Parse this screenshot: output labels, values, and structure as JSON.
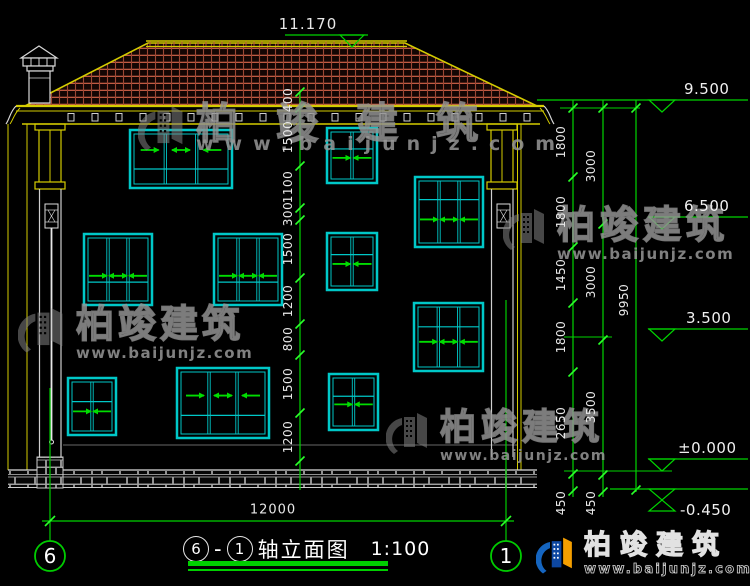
{
  "drawing": {
    "ridge_level": "11.170",
    "levels": [
      "9.500",
      "6.500",
      "3.500",
      "±0.000",
      "-0.450"
    ],
    "middle_chain": [
      "400",
      "1500",
      "1100",
      "300",
      "1500",
      "1200",
      "800",
      "1500",
      "1200"
    ],
    "right_chain_inner": [
      "1800",
      "1800",
      "1450",
      "1800",
      "2650",
      "450"
    ],
    "right_chain_outer": [
      "3000",
      "3000",
      "3500",
      "450"
    ],
    "total_height": "9950",
    "bottom_width": "12000",
    "axis_left": "6",
    "axis_right": "1",
    "title": {
      "axis_start": "6",
      "sep": "-",
      "axis_end": "1",
      "name": "轴立面图",
      "scale": "1:100"
    }
  },
  "watermark": {
    "brand": "柏竣建筑",
    "url": "www.baijunjz.com"
  },
  "logo": {
    "brand": "柏竣建筑",
    "url": "www.baijunjz.com"
  },
  "colors": {
    "dim_green": "#00d400",
    "tick_green": "#2aff2a",
    "window_cyan": "#00c8c8",
    "trim_yellow": "#d4cc00",
    "tile_red": "#b5503e",
    "text_white": "#e8e8e8"
  }
}
